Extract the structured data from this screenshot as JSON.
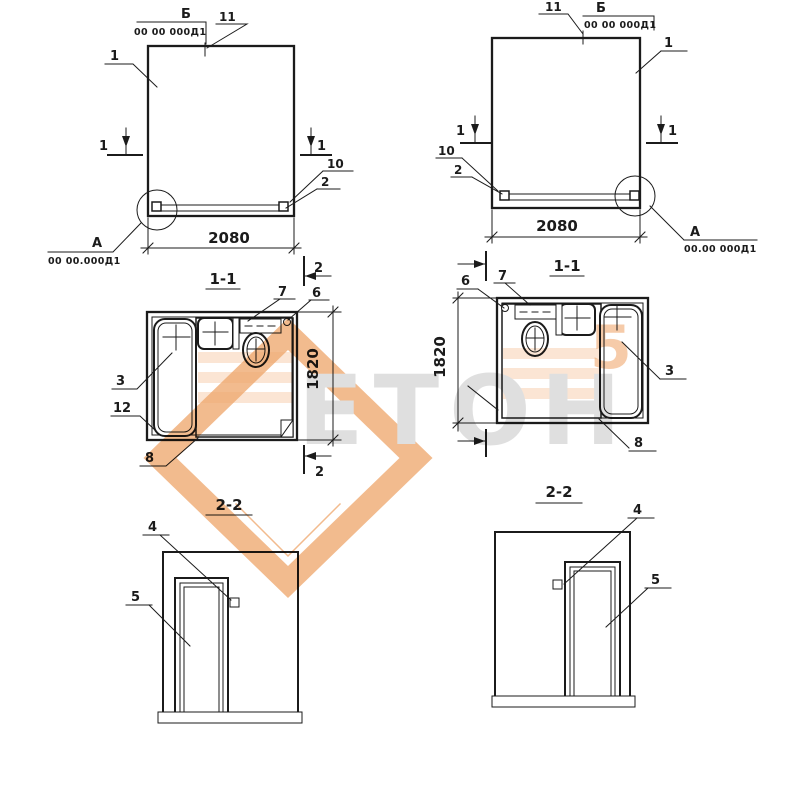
{
  "page": {
    "background": "#ffffff",
    "ink": "#1b1b1b"
  },
  "labels": {
    "view_b": "Б",
    "n1": "1",
    "n2": "2",
    "n3": "3",
    "n4": "4",
    "n5": "5",
    "n6": "6",
    "n7": "7",
    "n8": "8",
    "n10": "10",
    "n11": "11",
    "n12": "12",
    "node_a": "А"
  },
  "codes": {
    "top": "00 00 000Д1",
    "detail_left": "00 00.000Д1",
    "detail_right": "00.00 000Д1"
  },
  "dims": {
    "panel_width": "2080",
    "cabin_depth": "1820"
  },
  "view_titles": {
    "plan": "1-1",
    "door_section": "2-2"
  },
  "watermark": {
    "text": "ЕТОН",
    "accent": "5",
    "orange": "#ED9E5E",
    "gray": "#DCDCDC"
  }
}
